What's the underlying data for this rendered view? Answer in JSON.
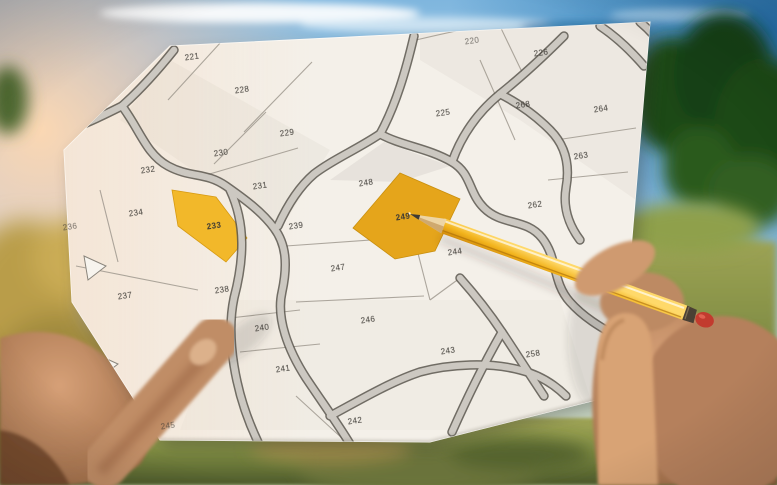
{
  "scene": {
    "type": "photo-of-hands-holding-cadastral-map",
    "objects": [
      "cadastral-parcel-map-sheet",
      "yellow-pencil",
      "left-hand",
      "right-hand",
      "blue-sky",
      "white-clouds",
      "sun-flare",
      "green-trees",
      "grass-field"
    ]
  },
  "colors": {
    "paper": "#f4f0e9",
    "road_fill": "#ccc8c1",
    "road_edge": "#5a564e",
    "parcel_line": "#9a948a",
    "parcel_number_ink": "#3b3833",
    "highlight_yellow": "#f2b82a",
    "highlight_yellow_deep": "#e5a51b",
    "pencil_yellow": "#f2b31c",
    "pencil_eraser_red": "#c23b2e",
    "sky_blue": "#79b3dc",
    "sky_flare": "#f8d2ae",
    "tree_green": "#1d4a16",
    "grass_green": "#7d8a42",
    "skin": "#c79675"
  },
  "map": {
    "kind": "cadastral-parcel-map",
    "highlighted_parcels": [
      "233",
      "249"
    ],
    "pointed_parcel": "249",
    "parcels": [
      {
        "id": "221",
        "x": 192,
        "y": 57,
        "highlighted": false,
        "partial": false
      },
      {
        "id": "228",
        "x": 242,
        "y": 90,
        "highlighted": false,
        "partial": false
      },
      {
        "id": "229",
        "x": 287,
        "y": 133,
        "highlighted": false,
        "partial": false
      },
      {
        "id": "230",
        "x": 221,
        "y": 153,
        "highlighted": false,
        "partial": false
      },
      {
        "id": "231",
        "x": 260,
        "y": 186,
        "highlighted": false,
        "partial": false
      },
      {
        "id": "232",
        "x": 148,
        "y": 170,
        "highlighted": false,
        "partial": false
      },
      {
        "id": "220",
        "x": 472,
        "y": 41,
        "highlighted": false,
        "partial": true
      },
      {
        "id": "225",
        "x": 443,
        "y": 113,
        "highlighted": false,
        "partial": false
      },
      {
        "id": "226",
        "x": 541,
        "y": 53,
        "highlighted": false,
        "partial": false
      },
      {
        "id": "268",
        "x": 523,
        "y": 105,
        "highlighted": false,
        "partial": false
      },
      {
        "id": "264",
        "x": 601,
        "y": 109,
        "highlighted": false,
        "partial": false
      },
      {
        "id": "263",
        "x": 581,
        "y": 156,
        "highlighted": false,
        "partial": false
      },
      {
        "id": "262",
        "x": 535,
        "y": 205,
        "highlighted": false,
        "partial": false
      },
      {
        "id": "248",
        "x": 366,
        "y": 183,
        "highlighted": false,
        "partial": false
      },
      {
        "id": "249",
        "x": 403,
        "y": 217,
        "highlighted": true,
        "partial": false
      },
      {
        "id": "239",
        "x": 296,
        "y": 226,
        "highlighted": false,
        "partial": false
      },
      {
        "id": "233",
        "x": 214,
        "y": 226,
        "highlighted": true,
        "partial": false
      },
      {
        "id": "234",
        "x": 136,
        "y": 213,
        "highlighted": false,
        "partial": false
      },
      {
        "id": "236",
        "x": 70,
        "y": 227,
        "highlighted": false,
        "partial": true
      },
      {
        "id": "244",
        "x": 455,
        "y": 252,
        "highlighted": false,
        "partial": false
      },
      {
        "id": "247",
        "x": 338,
        "y": 268,
        "highlighted": false,
        "partial": false
      },
      {
        "id": "237",
        "x": 125,
        "y": 296,
        "highlighted": false,
        "partial": false
      },
      {
        "id": "238",
        "x": 222,
        "y": 290,
        "highlighted": false,
        "partial": false
      },
      {
        "id": "240",
        "x": 262,
        "y": 328,
        "highlighted": false,
        "partial": false
      },
      {
        "id": "246",
        "x": 368,
        "y": 320,
        "highlighted": false,
        "partial": false
      },
      {
        "id": "241",
        "x": 283,
        "y": 369,
        "highlighted": false,
        "partial": false
      },
      {
        "id": "243",
        "x": 448,
        "y": 351,
        "highlighted": false,
        "partial": false
      },
      {
        "id": "258",
        "x": 533,
        "y": 354,
        "highlighted": false,
        "partial": false
      },
      {
        "id": "242",
        "x": 355,
        "y": 421,
        "highlighted": false,
        "partial": false
      },
      {
        "id": "245",
        "x": 168,
        "y": 426,
        "highlighted": false,
        "partial": true
      }
    ]
  }
}
